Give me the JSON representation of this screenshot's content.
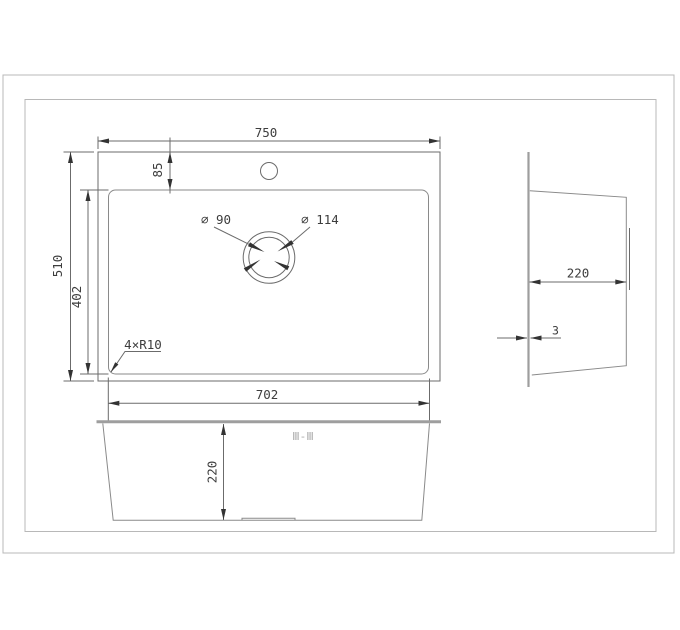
{
  "drawing": {
    "colors": {
      "line": "#6b6b6b",
      "thick_line": "#9e9e9e",
      "frame": "#b8b8b8",
      "text": "#3d3d3d",
      "section_text": "#a9a9a9"
    },
    "top_view": {
      "overall_width": "750",
      "overall_depth": "510",
      "rim_offset": "85",
      "bowl_depth": "402",
      "bowl_width": "702",
      "corner_radius": "4×R10",
      "drain_diameter": "⌀ 90",
      "drain_flange_diameter": "⌀ 114"
    },
    "side_view": {
      "depth": "220",
      "material_thickness": "3"
    },
    "front_view": {
      "bowl_height": "220",
      "section_label": "Ⅲ-Ⅲ"
    }
  }
}
